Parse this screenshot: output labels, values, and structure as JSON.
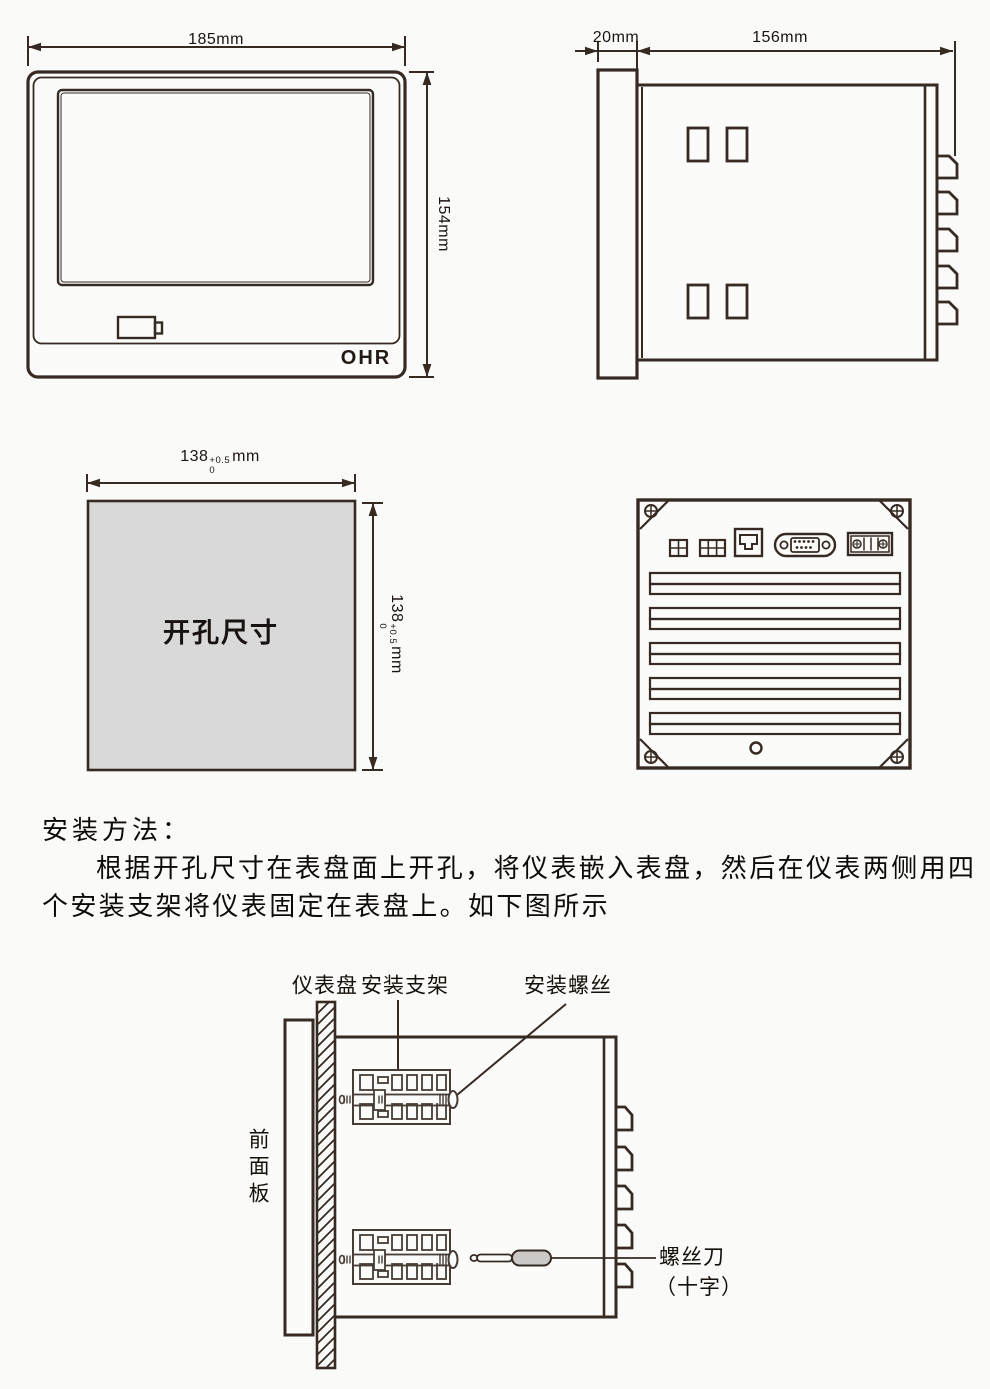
{
  "colors": {
    "ink": "#362a22",
    "panel_fill": "#d9d9d9",
    "handle_fill": "#cbc8c6"
  },
  "front_view": {
    "width_label": "185mm",
    "height_label": "154mm",
    "logo": "OHR"
  },
  "side_view": {
    "bezel_label": "20mm",
    "depth_label": "156mm"
  },
  "cutout": {
    "title": "开孔尺寸",
    "dim_value": "138",
    "tol_upper": "+0.5",
    "tol_lower": "0",
    "unit": "mm"
  },
  "instructions": {
    "heading": "安装方法：",
    "line1": "根据开孔尺寸在表盘面上开孔，将仪表嵌入表盘，然后在仪表两侧用四",
    "line2": "个安装支架将仪表固定在表盘上。如下图所示"
  },
  "install_diagram": {
    "panel_label": "仪表盘",
    "bracket_label": "安装支架",
    "screw_label": "安装螺丝",
    "front_panel_label": "前面板",
    "screwdriver_label": "螺丝刀",
    "screwdriver_type_label": "（十字）"
  }
}
